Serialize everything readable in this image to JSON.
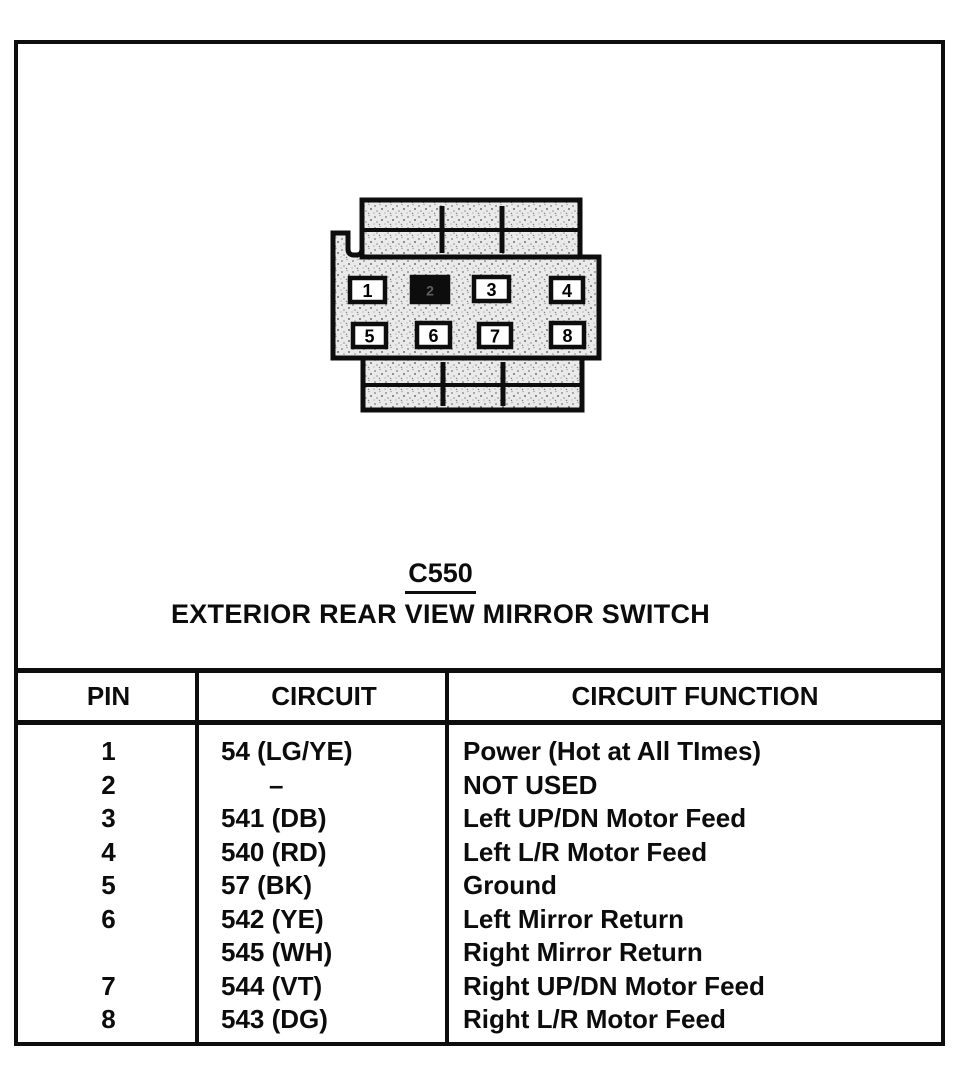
{
  "document": {
    "connector_label": "C550",
    "connector_title": "EXTERIOR REAR VIEW MIRROR SWITCH"
  },
  "connector": {
    "type": "8-pin connector face view",
    "pins": [
      "1",
      "2",
      "3",
      "4",
      "5",
      "6",
      "7",
      "8"
    ],
    "filled_pin": "2"
  },
  "table": {
    "headers": [
      "PIN",
      "CIRCUIT",
      "CIRCUIT FUNCTION"
    ],
    "rows": [
      {
        "pin": "1",
        "circuit": "54 (LG/YE)",
        "function": "Power (Hot at All TImes)"
      },
      {
        "pin": "2",
        "circuit": "–",
        "function": "NOT USED"
      },
      {
        "pin": "3",
        "circuit": "541 (DB)",
        "function": "Left UP/DN Motor Feed"
      },
      {
        "pin": "4",
        "circuit": "540 (RD)",
        "function": "Left L/R Motor Feed"
      },
      {
        "pin": "5",
        "circuit": "57 (BK)",
        "function": "Ground"
      },
      {
        "pin": "6",
        "circuit": "542 (YE)",
        "function": "Left Mirror Return"
      },
      {
        "pin": "",
        "circuit": "545 (WH)",
        "function": "Right Mirror Return"
      },
      {
        "pin": "7",
        "circuit": "544 (VT)",
        "function": "Right UP/DN Motor Feed"
      },
      {
        "pin": "8",
        "circuit": "543 (DG)",
        "function": "Right L/R Motor Feed"
      }
    ]
  },
  "colors": {
    "ink": "#0d0d0d",
    "paper": "#ffffff",
    "connector_fill": "#eaeaea"
  }
}
